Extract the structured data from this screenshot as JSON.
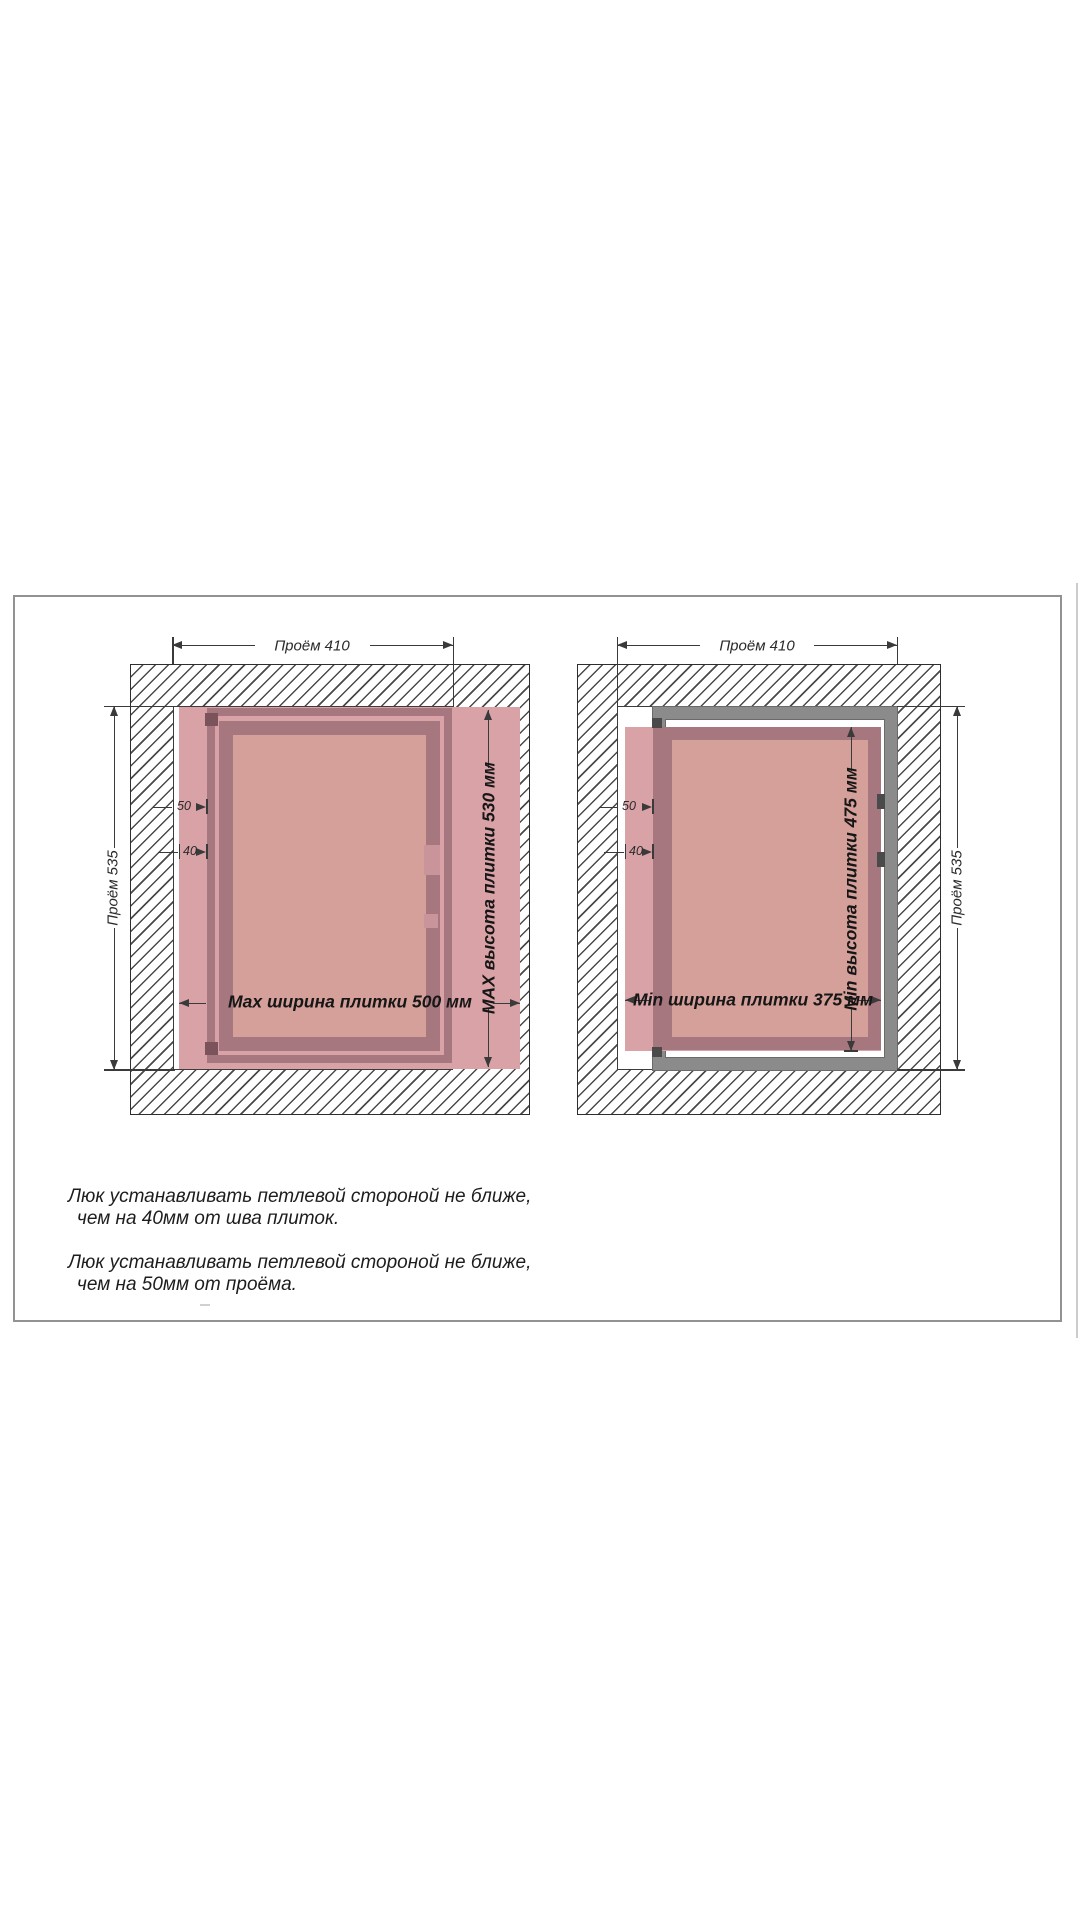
{
  "colors": {
    "tile": "#d9a2a6",
    "mauve": "#a6777e",
    "salmon": "#d5a09a",
    "grayframe": "#8b8b8b",
    "hinge": "#7b545b",
    "hingegray": "#4a4a4a",
    "notch": "#c9949a",
    "dim": "#3a3a3a",
    "wallline": "#2e2e2e",
    "hatchline": "#4a4a4a",
    "frameborder": "#929292",
    "edgeline": "#cccccc",
    "textcol": "#1d1d1d"
  },
  "diagram_left": {
    "opening_width_label": "Проём 410",
    "opening_height_label": "Проём 535",
    "tile_width_label": "Max ширина плитки 500 мм",
    "tile_height_label": "MAX высота плитки 530 мм",
    "hinge_offset_opening": "50",
    "hinge_offset_seam": "40"
  },
  "diagram_right": {
    "opening_width_label": "Проём 410",
    "opening_height_label": "Проём 535",
    "tile_width_label": "Min ширина плитки 375 мм",
    "tile_height_label": "Min высота плитки 475 мм",
    "hinge_offset_opening": "50",
    "hinge_offset_seam": "40"
  },
  "notes": {
    "note1_line1": "Люк устанавливать петлевой стороной не ближе,",
    "note1_line2": "чем на 40мм от шва плиток.",
    "note2_line1": "Люк устанавливать петлевой стороной не ближе,",
    "note2_line2": "чем на 50мм от проёма."
  }
}
